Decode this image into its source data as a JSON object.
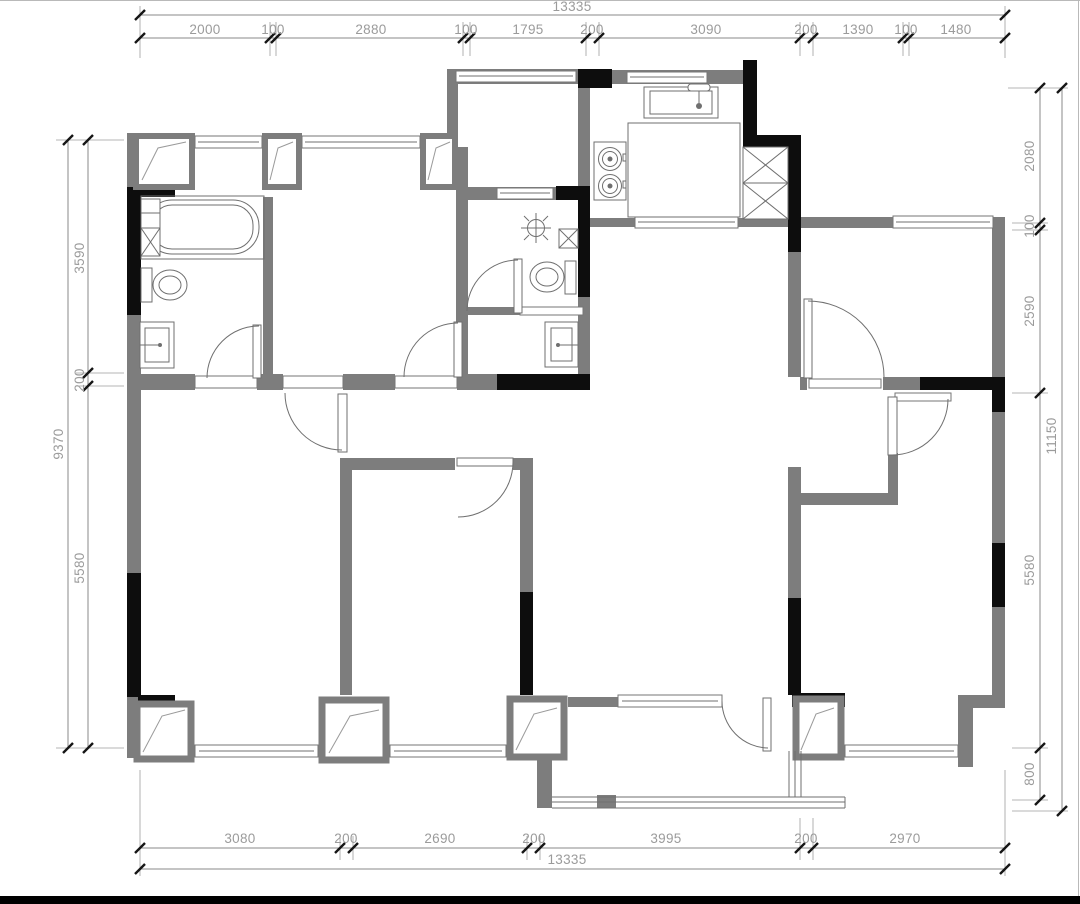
{
  "drawing": {
    "type": "apartment-floor-plan",
    "units": "mm",
    "dims": {
      "top": {
        "overall": "13335",
        "segments": [
          "2000",
          "100",
          "2880",
          "100",
          "1795",
          "200",
          "3090",
          "200",
          "1390",
          "100",
          "1480"
        ]
      },
      "bottom": {
        "overall": "13335",
        "segments": [
          "3080",
          "200",
          "2690",
          "200",
          "3995",
          "200",
          "2970"
        ]
      },
      "left": {
        "overall": "9370",
        "segments": [
          "3590",
          "200",
          "5580"
        ]
      },
      "right": {
        "overall": "11150",
        "segments": [
          "2080",
          "100",
          "2590",
          "5580",
          "800"
        ]
      }
    },
    "colors": {
      "wall_gray": "#7d7d7d",
      "wall_black": "#0d0d0d",
      "dimension_text": "#9b9b9b",
      "dimension_line": "#8a8a8a",
      "fixture_line": "#6f6f6f",
      "bottom_bar": "#000000"
    }
  }
}
